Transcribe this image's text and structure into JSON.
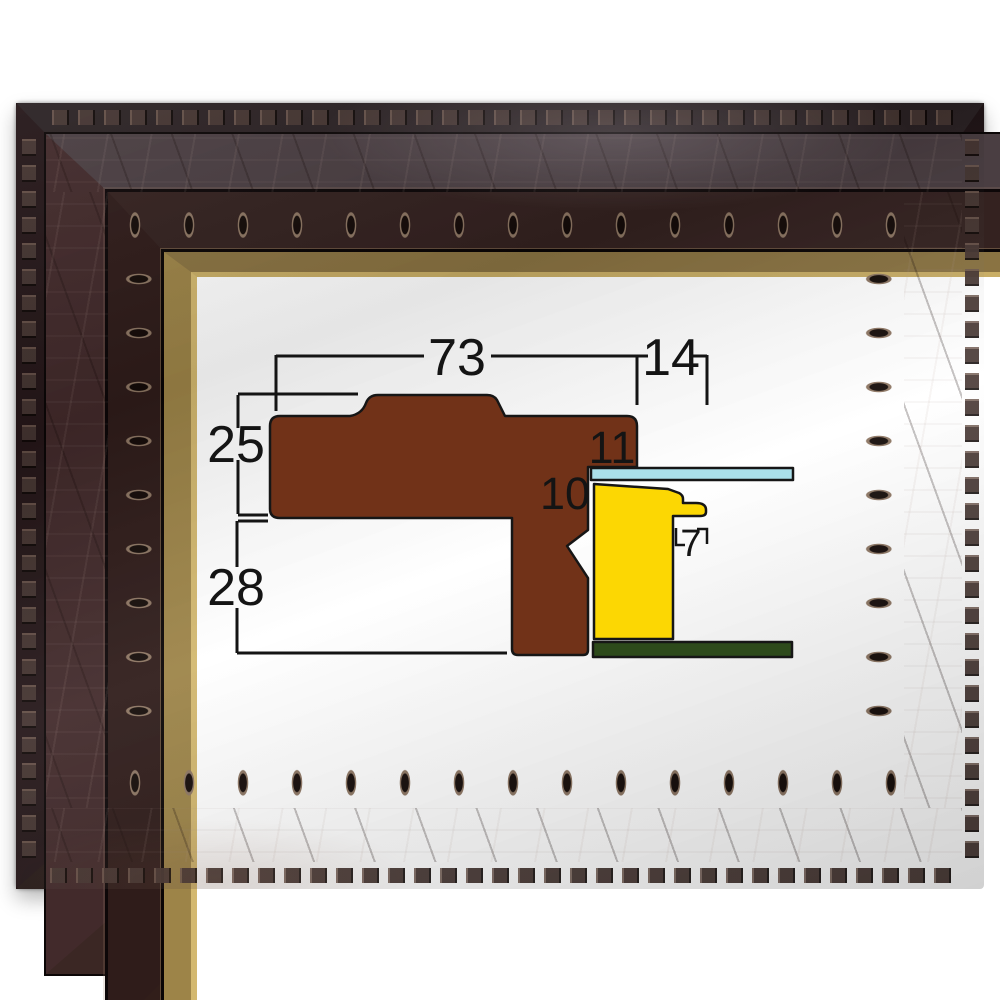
{
  "image": {
    "description": "Dark carved wood picture frame with gold liner; the opening shows a cross-section diagram of the frame moulding with millimeter dimensions"
  },
  "diagram": {
    "dimensions": {
      "outer_width": "73",
      "lip_overhang": "14",
      "upper_height": "25",
      "lower_depth": "28",
      "lip_height": "11",
      "rebate_depth": "10",
      "step_width": "7"
    },
    "colors": {
      "moulding": "#713218",
      "glass": "#aadfe9",
      "stretcher": "#fcd703",
      "backing": "#2d4a1b",
      "line": "#141414"
    }
  }
}
